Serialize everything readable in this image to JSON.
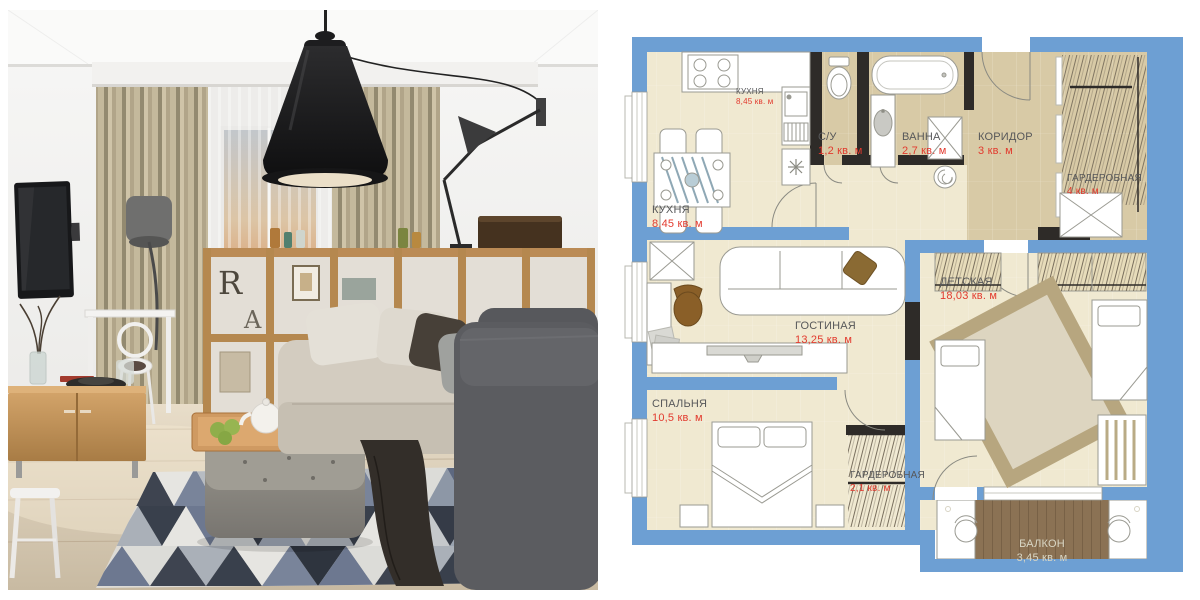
{
  "photo": {
    "shelf_letter_r": "R",
    "shelf_letter_a": "A",
    "palette": {
      "wall": "#f2f1ef",
      "curtain_beige": "#b3a78c",
      "sunset_warm": "#d9a379",
      "pendant_black": "#1a1a1c",
      "shelf_wood": "#b5884f",
      "sideboard_wood": "#c59a62",
      "sofa_beige": "#d3ccc0",
      "sofa_dark_grey": "#5b5c60",
      "rug_navy": "#3e4450",
      "rug_slate": "#6d7890",
      "apple_green": "#8fae4b"
    }
  },
  "plan": {
    "palette": {
      "wall_blue": "#6d9fd3",
      "wall_black": "#2e2b28",
      "floor_beige": "#f0e9d1",
      "floor_tan": "#d8caa6",
      "balcony_deck": "#8b7254",
      "room_name_grey": "#57585a",
      "area_red": "#e23a2e",
      "balcony_label": "#d9d6c4"
    },
    "rooms": [
      {
        "id": "kitchen-note",
        "name": "КУХНЯ",
        "area": "8,45 кв. м"
      },
      {
        "id": "kitchen",
        "name": "КУХНЯ",
        "area": "8,45 кв. м"
      },
      {
        "id": "wc",
        "name": "С/У",
        "area": "1,2 кв. м"
      },
      {
        "id": "bath",
        "name": "ВАННА",
        "area": "2,7 кв. м"
      },
      {
        "id": "corridor",
        "name": "КОРИДОР",
        "area": "3 кв. м"
      },
      {
        "id": "wardrobe-hall",
        "name": "ГАРДЕРОБНАЯ",
        "area": "4 кв. м"
      },
      {
        "id": "living",
        "name": "ГОСТИНАЯ",
        "area": "13,25 кв. м"
      },
      {
        "id": "kids",
        "name": "ДЕТСКАЯ",
        "area": "18,03 кв. м"
      },
      {
        "id": "bedroom",
        "name": "СПАЛЬНЯ",
        "area": "10,5 кв. м"
      },
      {
        "id": "wardrobe-bedroom",
        "name": "ГАРДЕРОБНАЯ",
        "area": "2,1 кв. м"
      },
      {
        "id": "balcony",
        "name": "БАЛКОН",
        "area": "3,45 кв. м"
      }
    ]
  }
}
